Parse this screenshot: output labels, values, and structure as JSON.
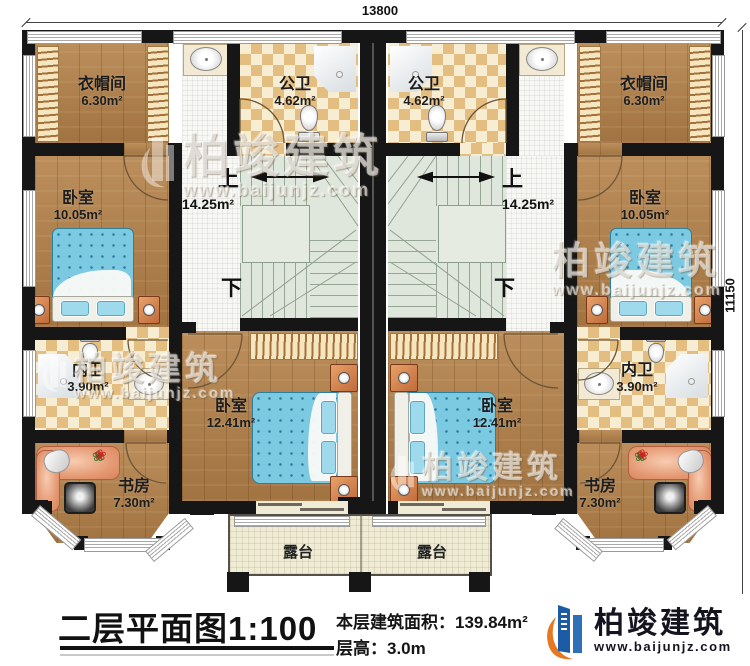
{
  "dims": {
    "width": "13800",
    "height": "11150"
  },
  "rooms": {
    "cloak_l": {
      "name": "衣帽间",
      "area": "6.30m²"
    },
    "cloak_r": {
      "name": "衣帽间",
      "area": "6.30m²"
    },
    "pubbath_l": {
      "name": "公卫",
      "area": "4.62m²"
    },
    "pubbath_r": {
      "name": "公卫",
      "area": "4.62m²"
    },
    "bed_l": {
      "name": "卧室",
      "area": "10.05m²"
    },
    "bed_r": {
      "name": "卧室",
      "area": "10.05m²"
    },
    "hall_l": {
      "area": "14.25m²",
      "up": "上",
      "down": "下"
    },
    "hall_r": {
      "area": "14.25m²",
      "up": "上",
      "down": "下"
    },
    "ensuite_l": {
      "name": "内卫",
      "area": "3.90m²"
    },
    "ensuite_r": {
      "name": "内卫",
      "area": "3.90m²"
    },
    "midbed_l": {
      "name": "卧室",
      "area": "12.41m²"
    },
    "midbed_r": {
      "name": "卧室",
      "area": "12.41m²"
    },
    "study_l": {
      "name": "书房",
      "area": "7.30m²"
    },
    "study_r": {
      "name": "书房",
      "area": "7.30m²"
    },
    "terrace_l": {
      "name": "露台"
    },
    "terrace_r": {
      "name": "露台"
    }
  },
  "title": {
    "name": "二层平面图",
    "scale": "1:100",
    "area_label": "本层建筑面积：",
    "area_value": "139.84m²",
    "height_label": "层高：",
    "height_value": "3.0m"
  },
  "brand": {
    "name": "柏竣建筑",
    "url": "www.baijunjz.com"
  },
  "colors": {
    "wall": "#161616",
    "wood": "#b2814c",
    "checker_tan": "#e4bd80",
    "stair": "#dfe6dc",
    "terrace": "#efebd5",
    "bed_blue": "#7cc9e2",
    "logo_blue": "#1d5ba6",
    "logo_orange": "#e87722"
  }
}
